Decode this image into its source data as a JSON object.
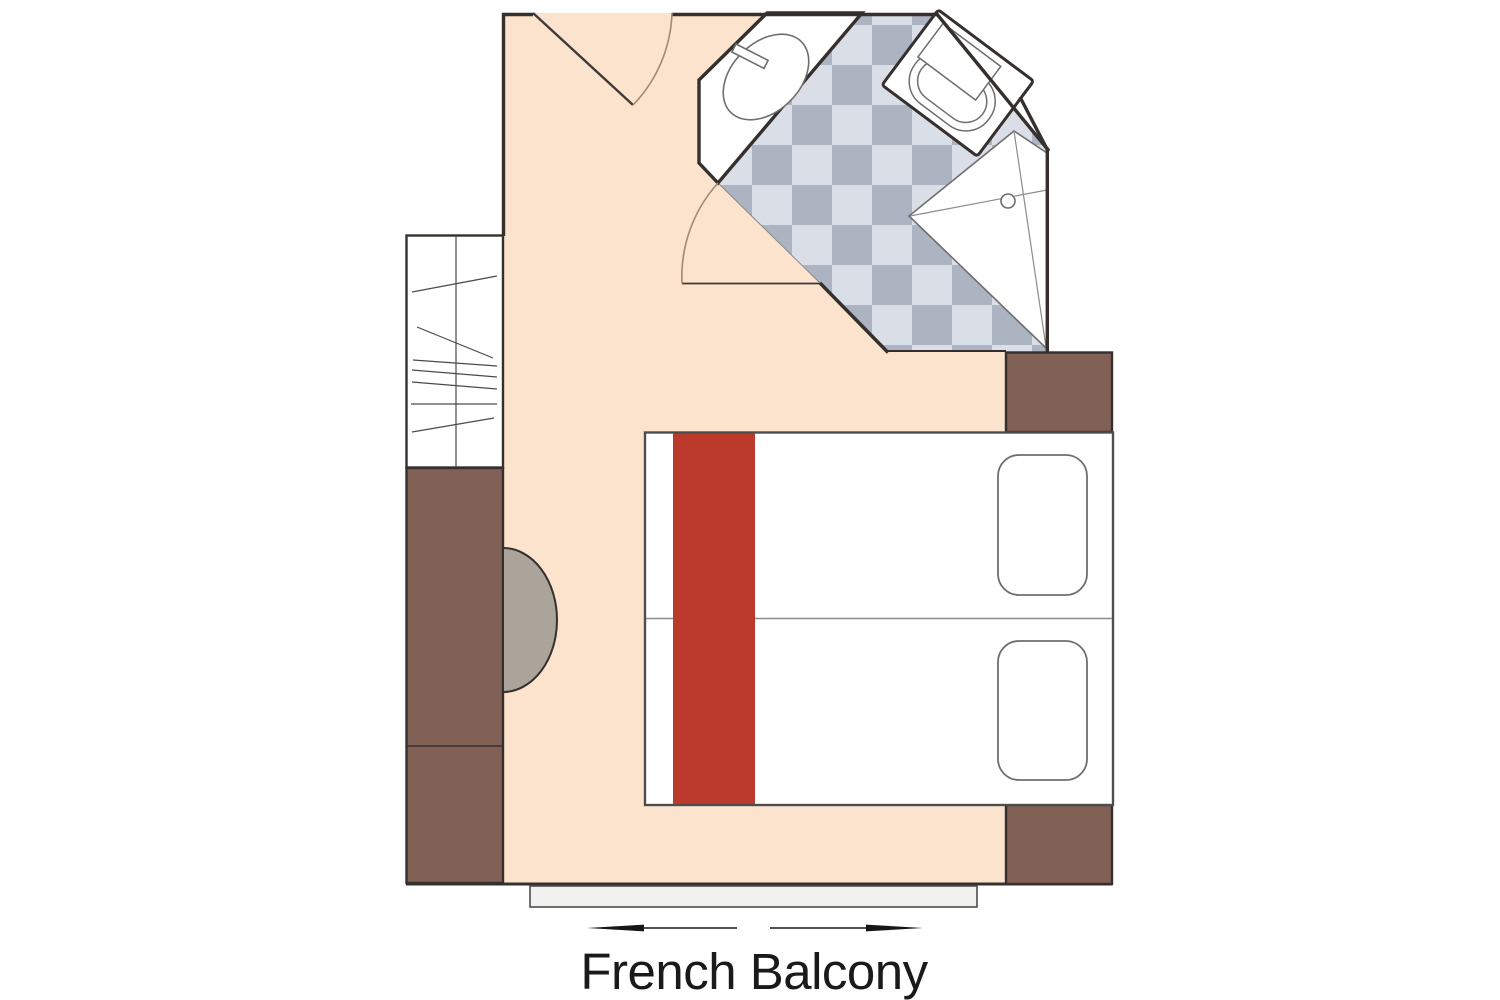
{
  "label": {
    "text": "French Balcony"
  },
  "colors": {
    "page_bg": "#FFFFFF",
    "floor": "#FBE3CD",
    "wall": "#35302E",
    "brown": "#816055",
    "red": "#BC3A2C",
    "table": "#ABA49A",
    "checker_light": "#D9DEE7",
    "checker_dark": "#ACB4C1",
    "balcony": "#F1F1EF",
    "white": "#FFFFFF",
    "fixture_line": "#6E6E6E",
    "thin_line": "#8C8C8C",
    "closet_line": "#4A4A4A",
    "bed_border": "#4D4D4D",
    "door_dark": "#3F3A38",
    "arc": "#A08977",
    "arrow": "#161616",
    "text": "#1A1A1A"
  },
  "icons": {
    "entry_door": "door-swing-icon",
    "bathroom_door": "door-swing-icon",
    "sink": "sink-basin-icon",
    "toilet": "toilet-icon",
    "shower": "shower-drain-icon",
    "beds": "twin-beds-icon",
    "pillows": "pillow-icon",
    "wardrobe": "wardrobe-icon",
    "side_table": "half-round-table-icon",
    "balcony_arrows": "sliding-door-arrows-icon"
  }
}
